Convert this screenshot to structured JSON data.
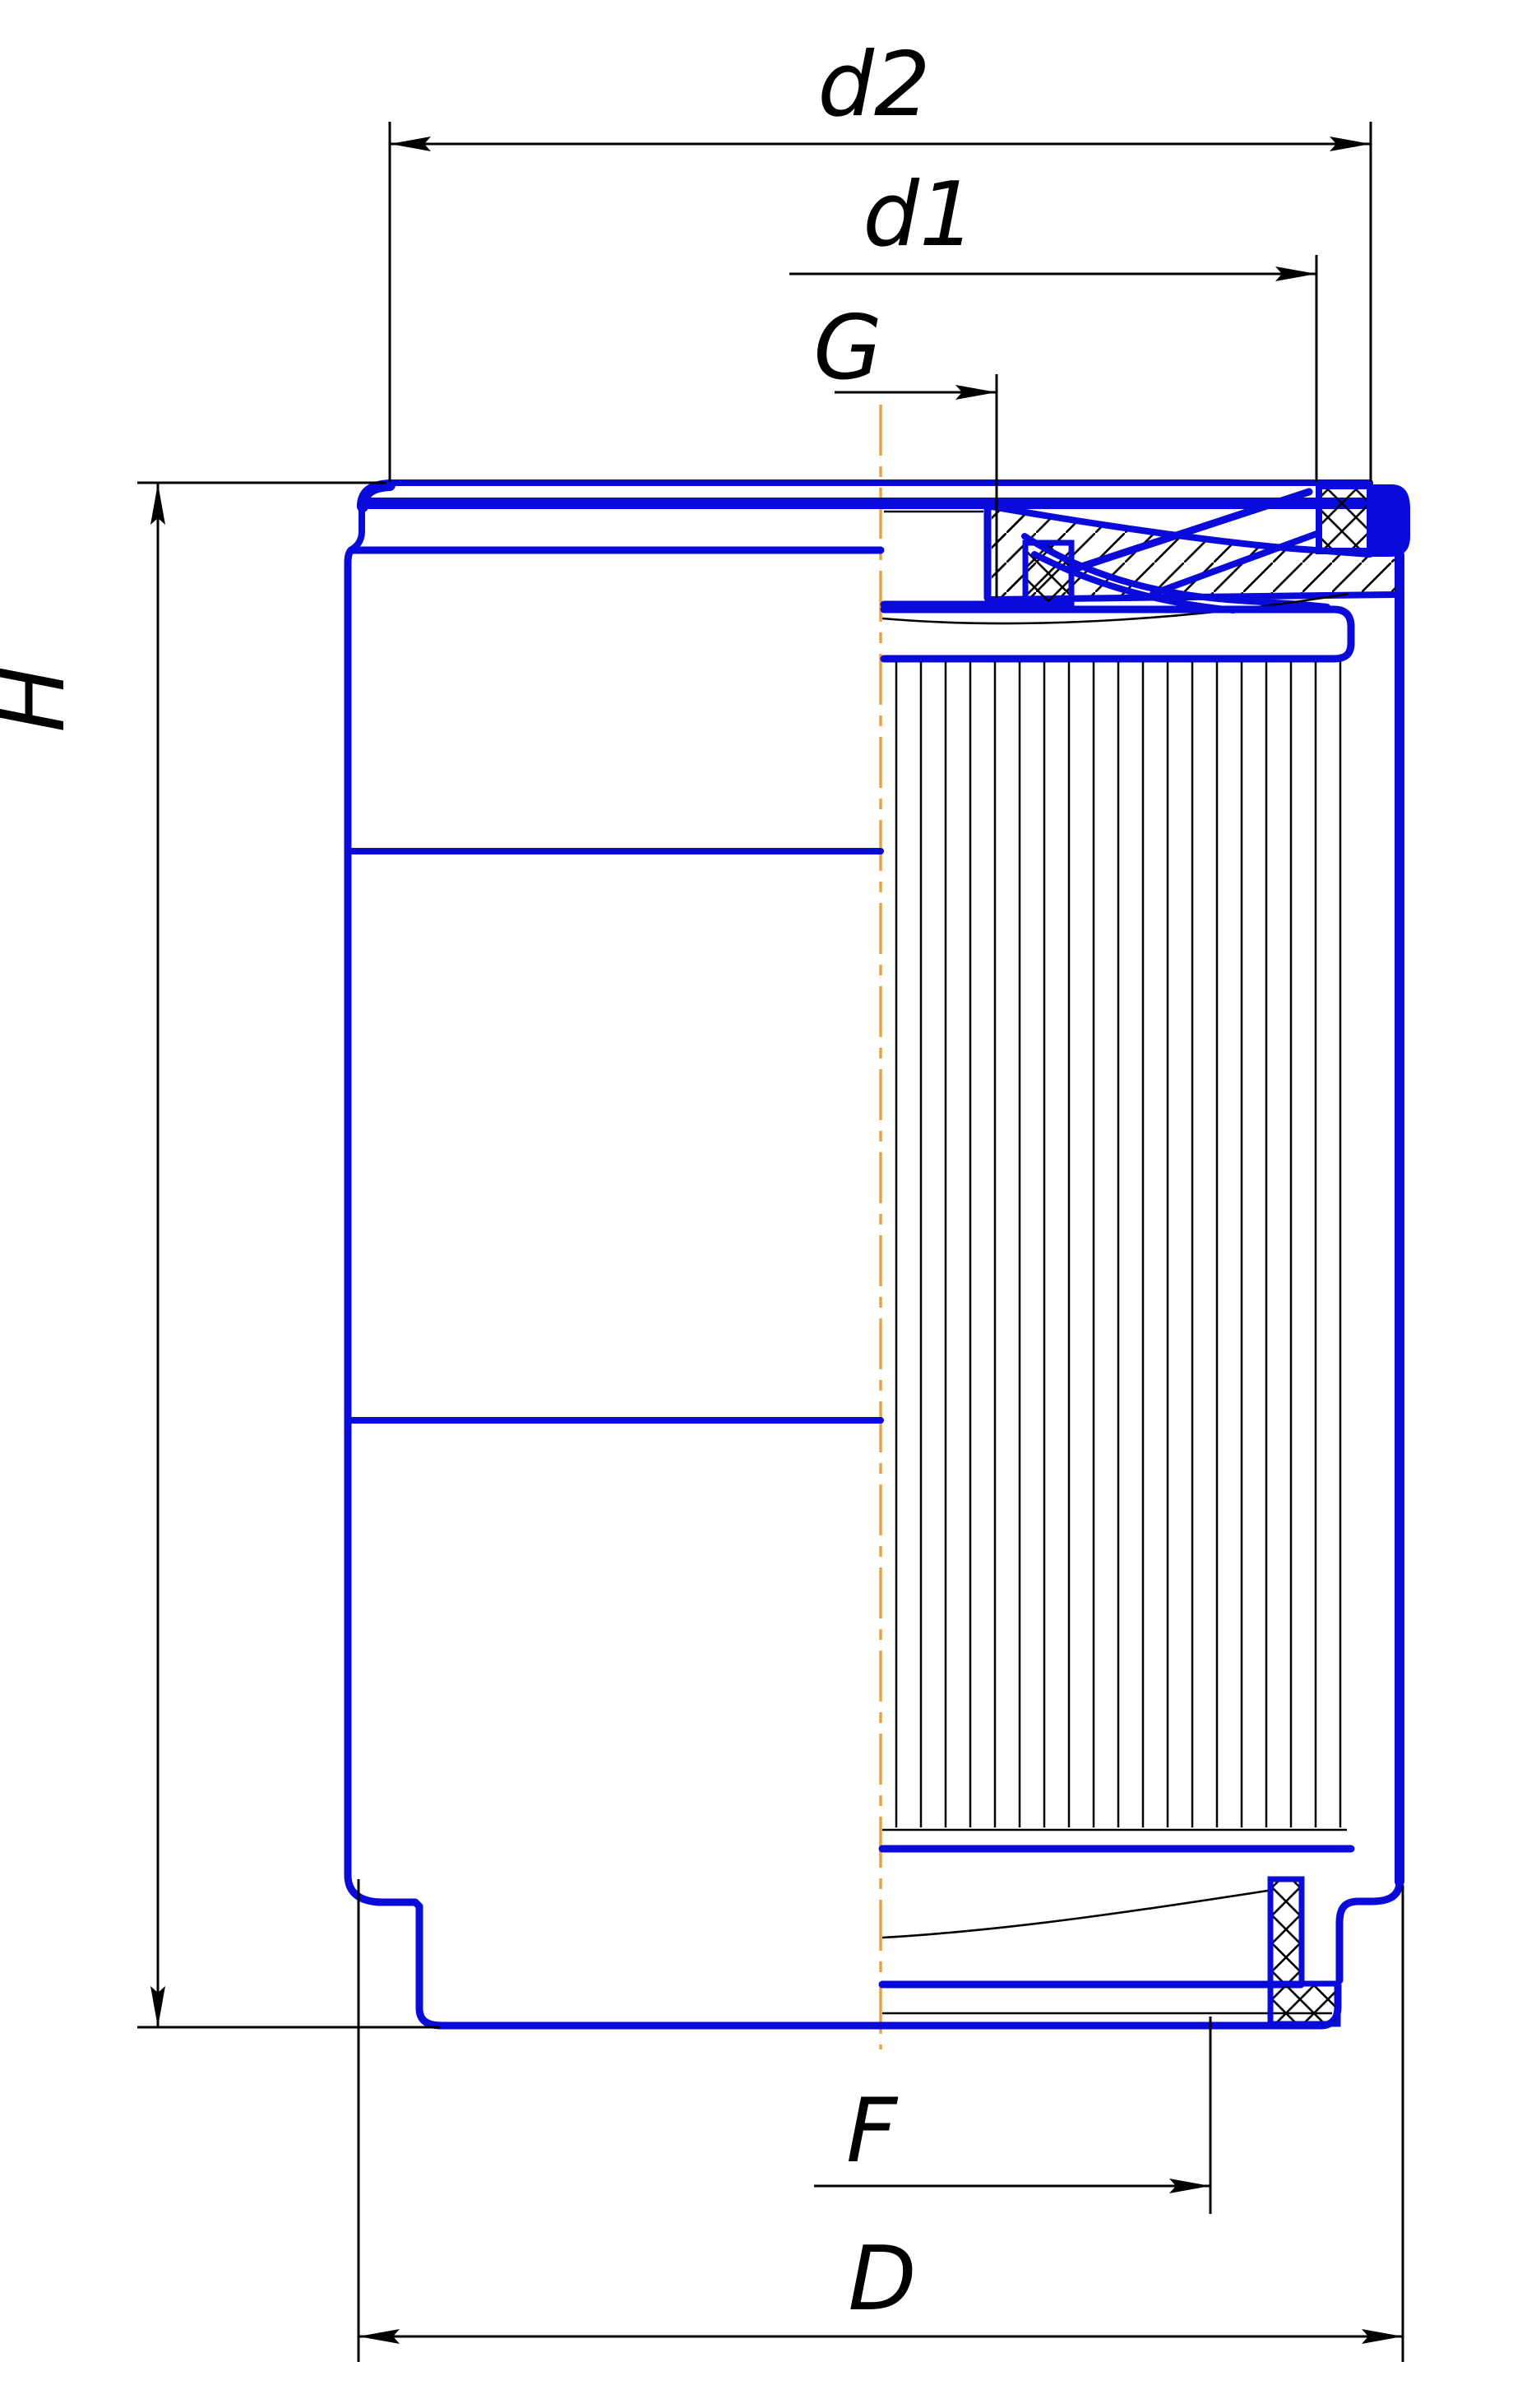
{
  "drawing": {
    "labels": {
      "d2": "d2",
      "d1": "d1",
      "thread": "G",
      "height": "H",
      "bottom_dia": "F",
      "outer_dia": "D"
    },
    "colors": {
      "body_outline": "#0a0ada",
      "dimension_lines": "#000000",
      "hatch": "#000000",
      "centerline": "#e8a33d",
      "background": "#ffffff"
    }
  }
}
